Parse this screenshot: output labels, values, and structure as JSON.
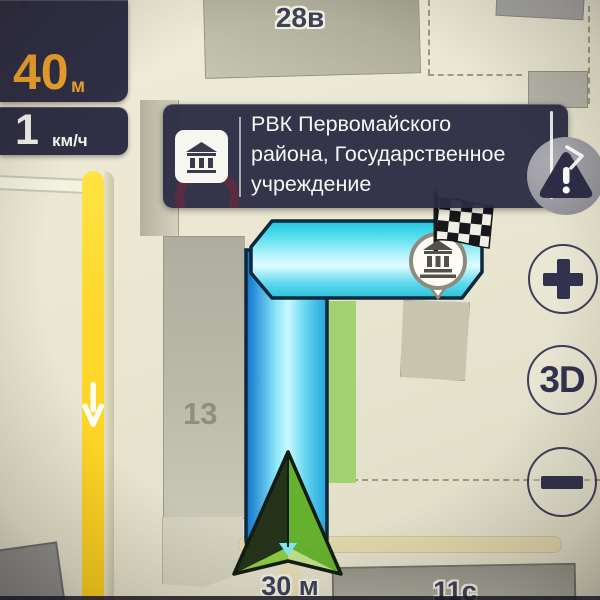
{
  "app": "navigation-map",
  "hud": {
    "distance_value": "40",
    "distance_unit": "м",
    "speed_value": "1",
    "speed_unit": "км/ч"
  },
  "poi_popup": {
    "line1": "РВК Первомайского",
    "line2": "района, Государственное",
    "line3": "учреждение"
  },
  "controls": {
    "view_mode_label": "3D"
  },
  "map_labels": {
    "building_top": "28в",
    "building_left": "13",
    "building_bottom_right": "11с",
    "route_distance": "30 м"
  },
  "icons": {
    "popup": "government-building-icon",
    "destination_marker": "government-building-icon",
    "finish": "finish-flag-icon",
    "alert": "warning-triangle-icon",
    "zoom_in": "plus-icon",
    "zoom_out": "minus-icon",
    "road_direction": "down-arrow-icon",
    "position": "navigation-arrow-icon"
  },
  "colors": {
    "route_cyan": "#35d4e9",
    "route_blue": "#1a7fd0",
    "road_yellow": "#ffd92e",
    "hud_navy": "#2a2a45",
    "accent_orange": "#f2a52c",
    "arrow_green": "#66b22e",
    "map_beige": "#e9e6d1"
  }
}
